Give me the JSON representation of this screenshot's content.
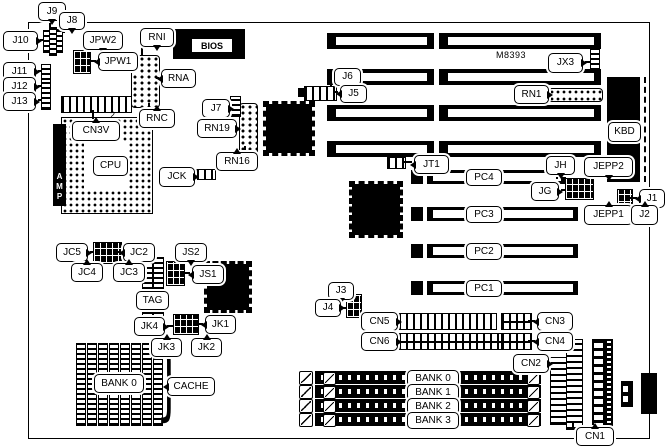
{
  "labels": {
    "j9": "J9",
    "j8": "J8",
    "j10": "J10",
    "j11": "J11",
    "j12": "J12",
    "j13": "J13",
    "jpw2": "JPW2",
    "jpw1": "JPW1",
    "rni": "RNI",
    "rna": "RNA",
    "rnc": "RNC",
    "cn3v": "CN3V",
    "j7": "J7",
    "rn19": "RN19",
    "rn16": "RN16",
    "jck": "JCK",
    "j6": "J6",
    "j5": "J5",
    "jx3": "JX3",
    "rn1": "RN1",
    "jt1": "JT1",
    "jh": "JH",
    "jg": "JG",
    "jepp2": "JEPP2",
    "jepp1": "JEPP1",
    "j1": "J1",
    "j2": "J2",
    "jc5": "JC5",
    "jc2": "JC2",
    "jc4": "JC4",
    "jc3": "JC3",
    "js2": "JS2",
    "js1": "JS1",
    "tag": "TAG",
    "jk4": "JK4",
    "jk1": "JK1",
    "jk3": "JK3",
    "jk2": "JK2",
    "j3": "J3",
    "j4": "J4",
    "cn5": "CN5",
    "cn6": "CN6",
    "cn3": "CN3",
    "cn4": "CN4",
    "cn2": "CN2",
    "cn1": "CN1",
    "kbd": "KBD",
    "cpu": "CPU",
    "cache_bank": "BANK 0",
    "cache": "CACHE"
  },
  "chip_text": {
    "bios": "BIOS",
    "amp": "AMP",
    "marking": "M8393",
    "cn3v_pin": "2",
    "cache_brace": "}"
  },
  "pc_slots": [
    "PC4",
    "PC3",
    "PC2",
    "PC1"
  ],
  "simm_banks": [
    "BANK 0",
    "BANK 1",
    "BANK 2",
    "BANK 3"
  ],
  "colors": {
    "ink": "#000000",
    "paper": "#ffffff"
  }
}
